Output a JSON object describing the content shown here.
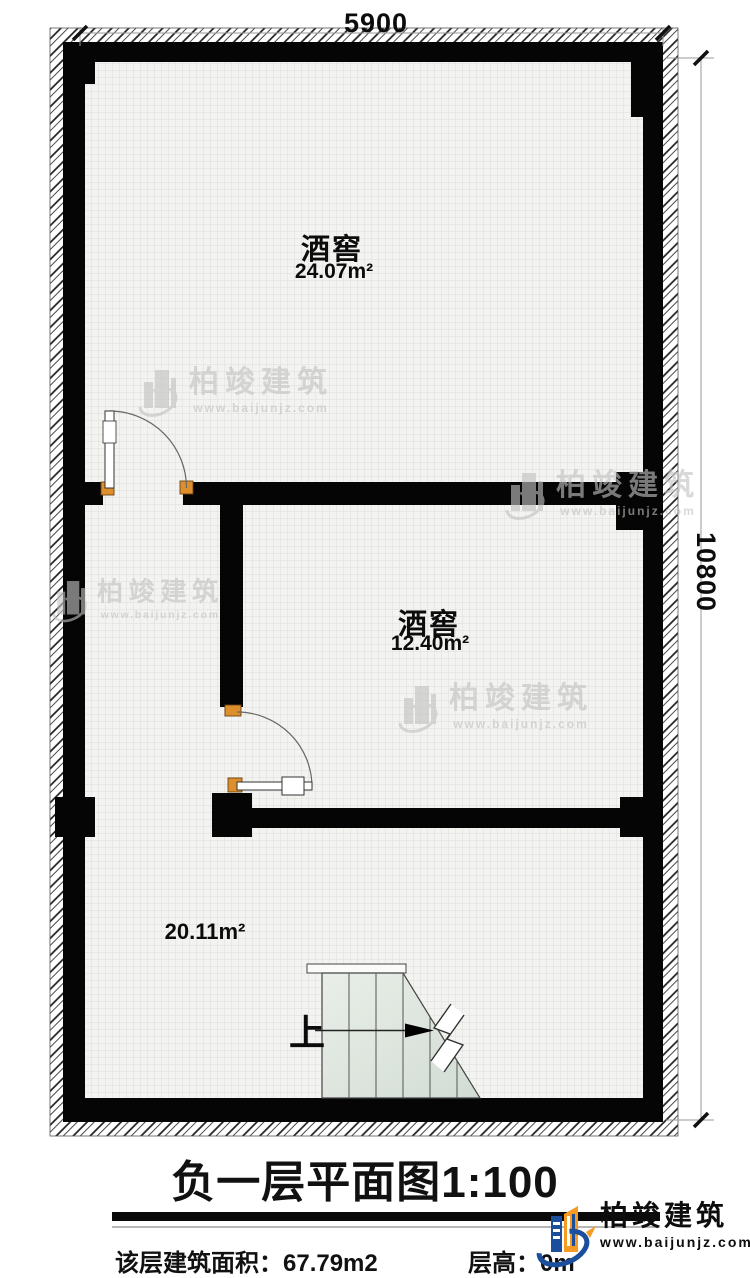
{
  "dimensions": {
    "top": "5900",
    "right": "10800"
  },
  "rooms": [
    {
      "name": "酒窖",
      "area": "24.07m²"
    },
    {
      "name": "酒窖",
      "area": "12.40m²"
    },
    {
      "name": "",
      "area": "20.11m²"
    }
  ],
  "stairs": {
    "up_label": "上"
  },
  "watermark": {
    "name": "柏竣建筑",
    "url": "www.baijunjz.com"
  },
  "title": {
    "text": "负一层平面图",
    "scale": "1:100"
  },
  "footer": {
    "area_label": "该层建筑面积：",
    "area_value": "67.79m2",
    "height_label": "层高：",
    "height_value_visible": "0m"
  },
  "logo": {
    "name": "柏竣建筑",
    "url": "www.baijunjz.com"
  },
  "colors": {
    "wall": "#050505",
    "hinge": "#dd8f2d",
    "logo_blue": "#1b4f9c",
    "logo_orange": "#f59a23"
  }
}
